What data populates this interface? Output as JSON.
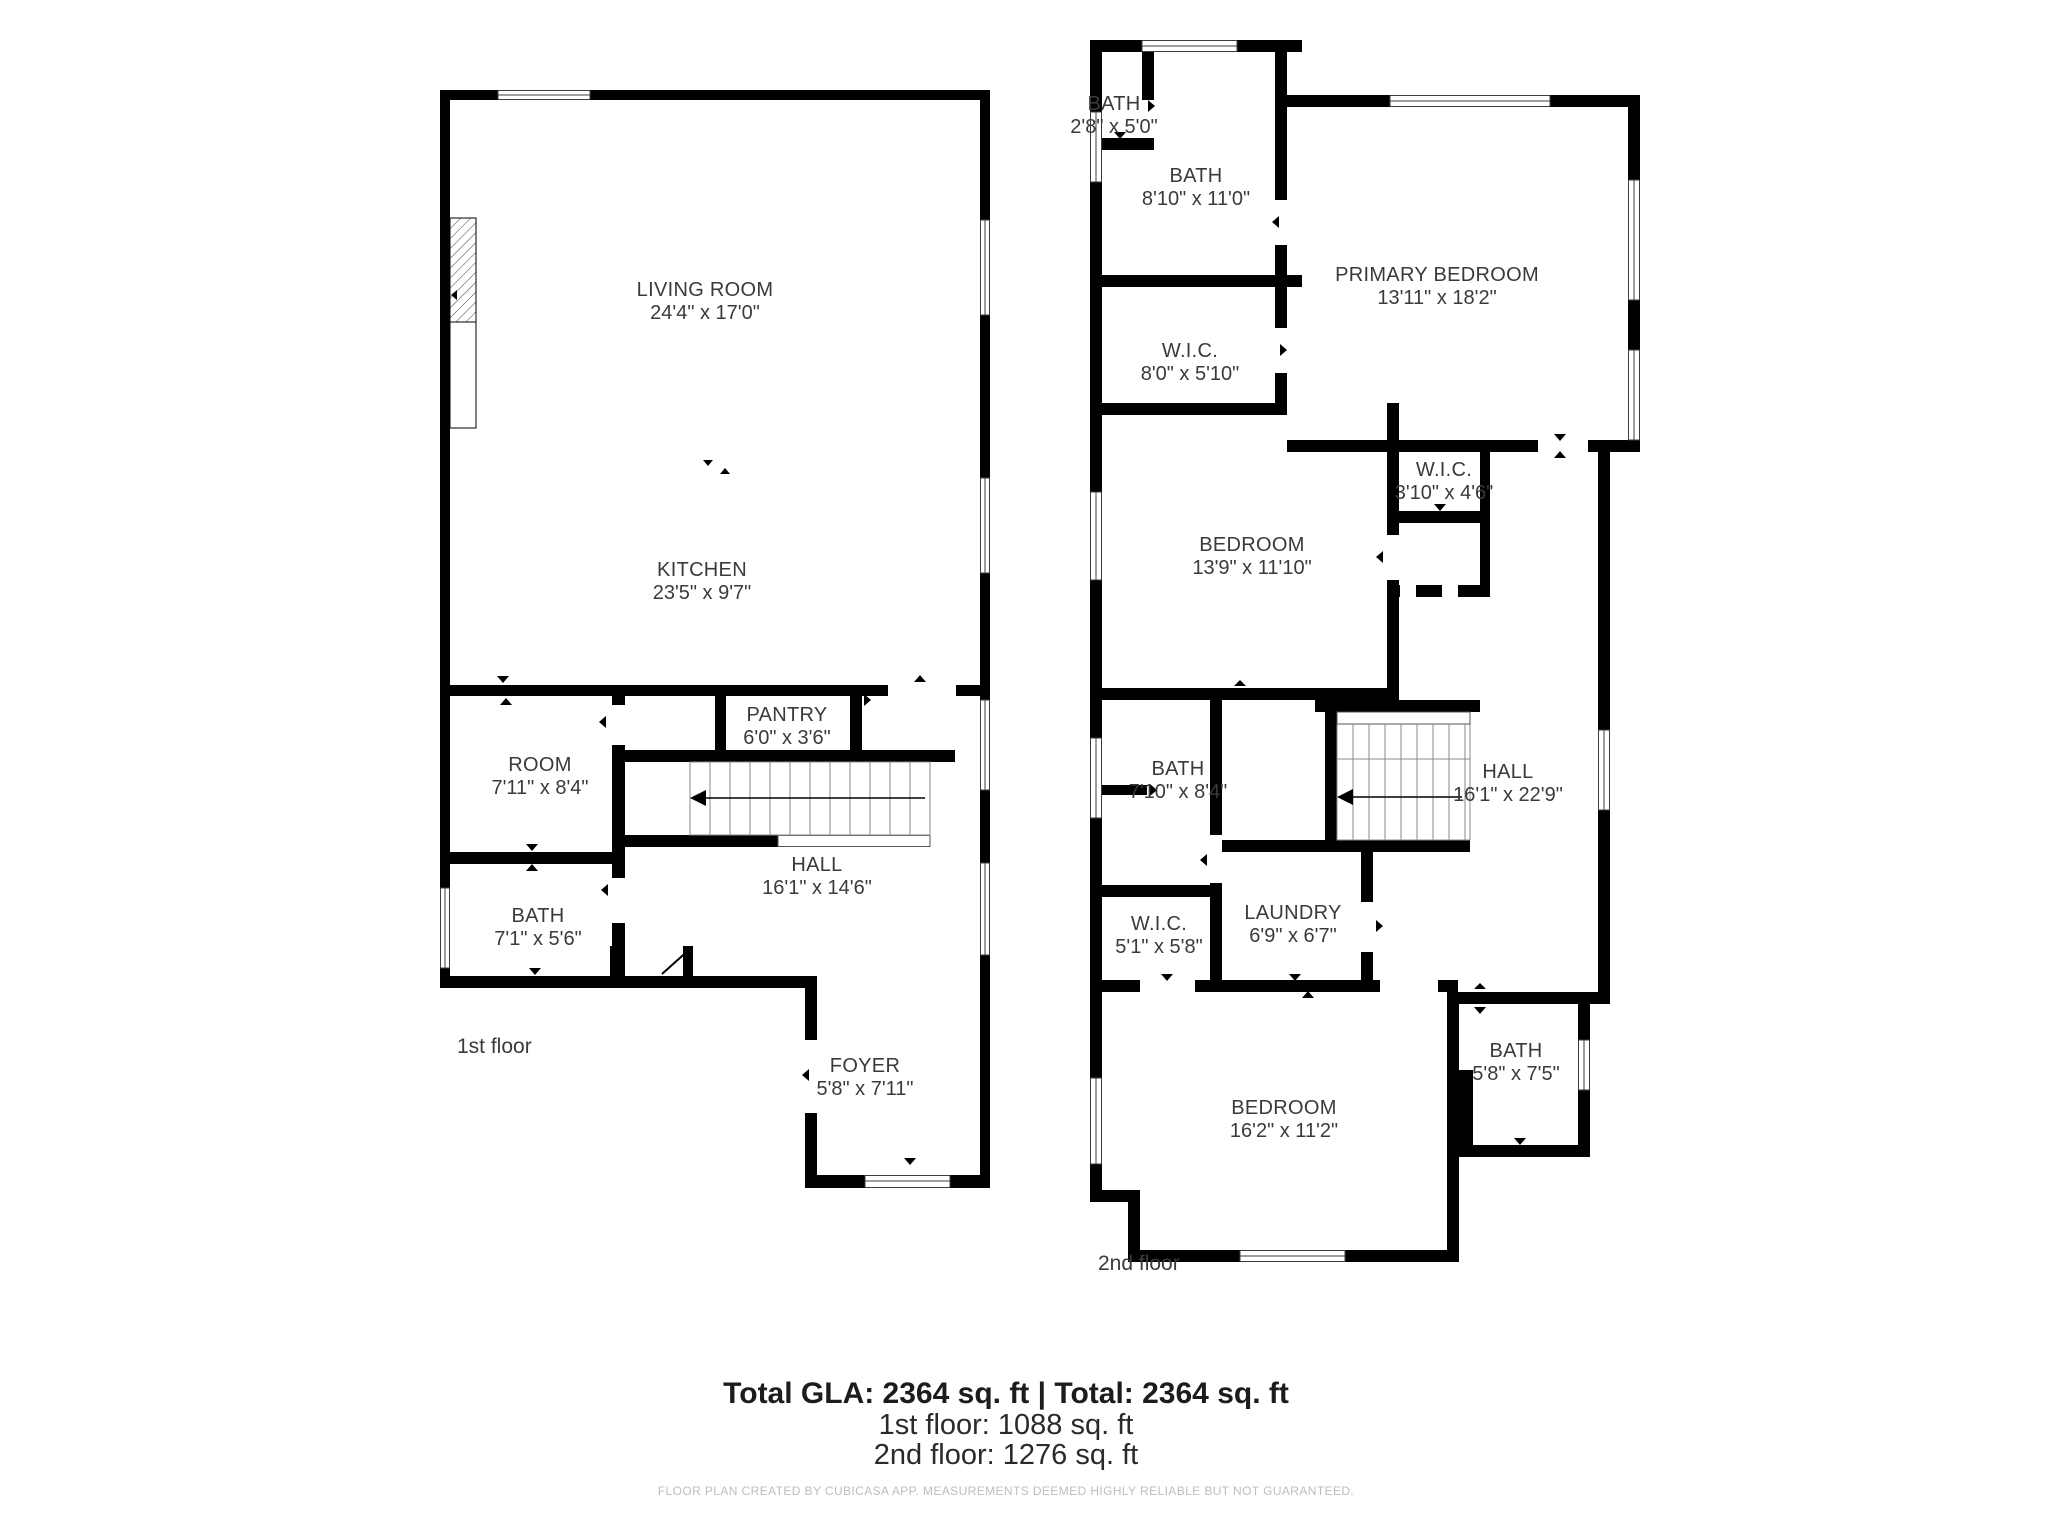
{
  "floors": [
    {
      "name": "1st floor",
      "rooms": [
        {
          "name": "LIVING ROOM",
          "dimensions": "24'4\" x 17'0\""
        },
        {
          "name": "KITCHEN",
          "dimensions": "23'5\" x 9'7\""
        },
        {
          "name": "ROOM",
          "dimensions": "7'11\" x 8'4\""
        },
        {
          "name": "PANTRY",
          "dimensions": "6'0\" x 3'6\""
        },
        {
          "name": "HALL",
          "dimensions": "16'1\" x 14'6\""
        },
        {
          "name": "BATH",
          "dimensions": "7'1\" x 5'6\""
        },
        {
          "name": "FOYER",
          "dimensions": "5'8\" x 7'11\""
        }
      ]
    },
    {
      "name": "2nd floor",
      "rooms": [
        {
          "name": "BATH",
          "dimensions": "2'8\" x 5'0\""
        },
        {
          "name": "BATH",
          "dimensions": "8'10\" x 11'0\""
        },
        {
          "name": "PRIMARY BEDROOM",
          "dimensions": "13'11\" x 18'2\""
        },
        {
          "name": "W.I.C.",
          "dimensions": "8'0\" x 5'10\""
        },
        {
          "name": "W.I.C.",
          "dimensions": "3'10\" x 4'6\""
        },
        {
          "name": "BEDROOM",
          "dimensions": "13'9\" x 11'10\""
        },
        {
          "name": "BATH",
          "dimensions": "7'10\" x 8'4\""
        },
        {
          "name": "HALL",
          "dimensions": "16'1\" x 22'9\""
        },
        {
          "name": "W.I.C.",
          "dimensions": "5'1\" x 5'8\""
        },
        {
          "name": "LAUNDRY",
          "dimensions": "6'9\" x 6'7\""
        },
        {
          "name": "BEDROOM",
          "dimensions": "16'2\" x 11'2\""
        },
        {
          "name": "BATH",
          "dimensions": "5'8\" x 7'5\""
        }
      ]
    }
  ],
  "summary": {
    "total_line": "Total GLA: 2364 sq. ft | Total: 2364 sq. ft",
    "first_floor_line": "1st floor: 1088 sq. ft",
    "second_floor_line": "2nd floor: 1276 sq. ft"
  },
  "disclaimer": "FLOOR PLAN CREATED BY CUBICASA APP. MEASUREMENTS DEEMED HIGHLY RELIABLE BUT NOT GUARANTEED.",
  "colors": {
    "wall": "#000000",
    "label_text": "#3a3a3a",
    "summary_text": "#1c1c1c",
    "disclaimer_text": "#bdbdbd",
    "background": "#ffffff"
  }
}
